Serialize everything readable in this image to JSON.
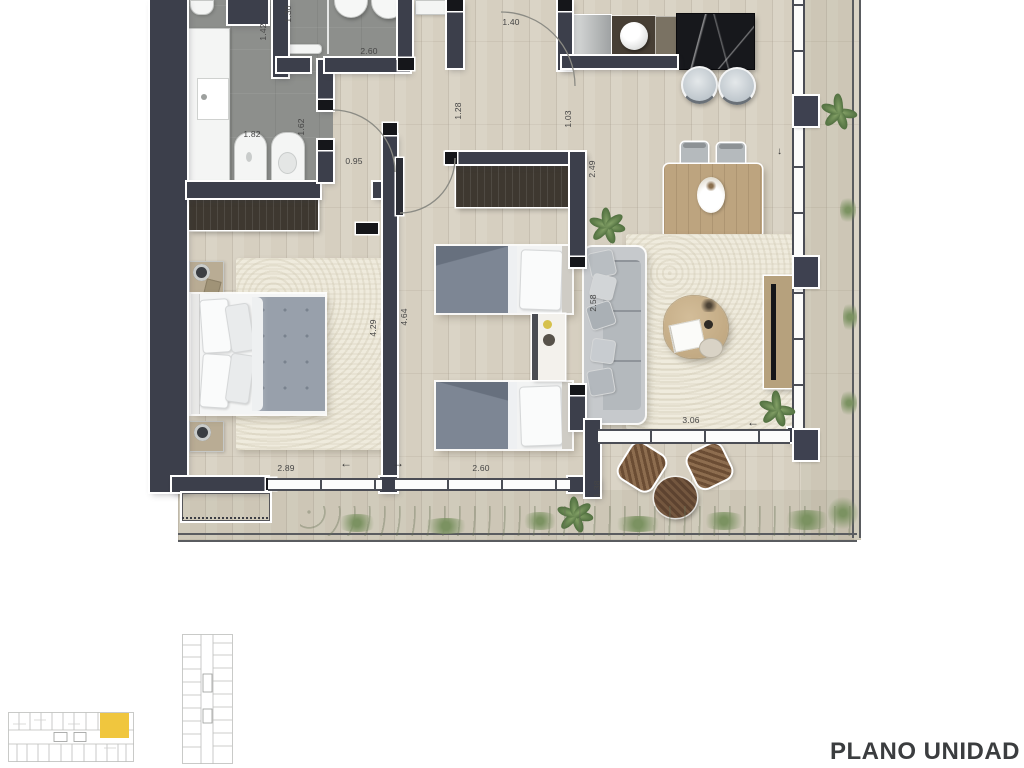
{
  "caption": {
    "title": "PLANO UNIDAD"
  },
  "dims": [
    {
      "id": "bath2-width",
      "text": "1.30"
    },
    {
      "id": "shaft-width",
      "text": "1.42"
    },
    {
      "id": "bath2-length",
      "text": "2.60"
    },
    {
      "id": "entry-width",
      "text": "1.40"
    },
    {
      "id": "vanity-length",
      "text": "1.82"
    },
    {
      "id": "bath1-depth",
      "text": "1.62"
    },
    {
      "id": "hall-width",
      "text": "0.95"
    },
    {
      "id": "hall2-width",
      "text": "1.28"
    },
    {
      "id": "kitchen-pass",
      "text": "1.03"
    },
    {
      "id": "bedroom2-depth",
      "text": "2.49"
    },
    {
      "id": "bedroom1-length",
      "text": "4.29"
    },
    {
      "id": "bedroom2-length",
      "text": "4.64"
    },
    {
      "id": "living-width",
      "text": "2.58"
    },
    {
      "id": "bedroom1-width",
      "text": "2.89"
    },
    {
      "id": "bedroom2-width",
      "text": "2.60"
    },
    {
      "id": "living-window",
      "text": "3.06"
    },
    {
      "id": "terrace-depth",
      "text": "1.38"
    }
  ],
  "arrows": {
    "left": "←",
    "right": "→",
    "down": "↓"
  },
  "colors": {
    "wall": "#3c3f4b",
    "highlight_unit": "#f0c63e",
    "wood_floor": "#d6cfc0",
    "tile_floor": "#8d8f8c",
    "caption_text": "#3b3d3f"
  }
}
